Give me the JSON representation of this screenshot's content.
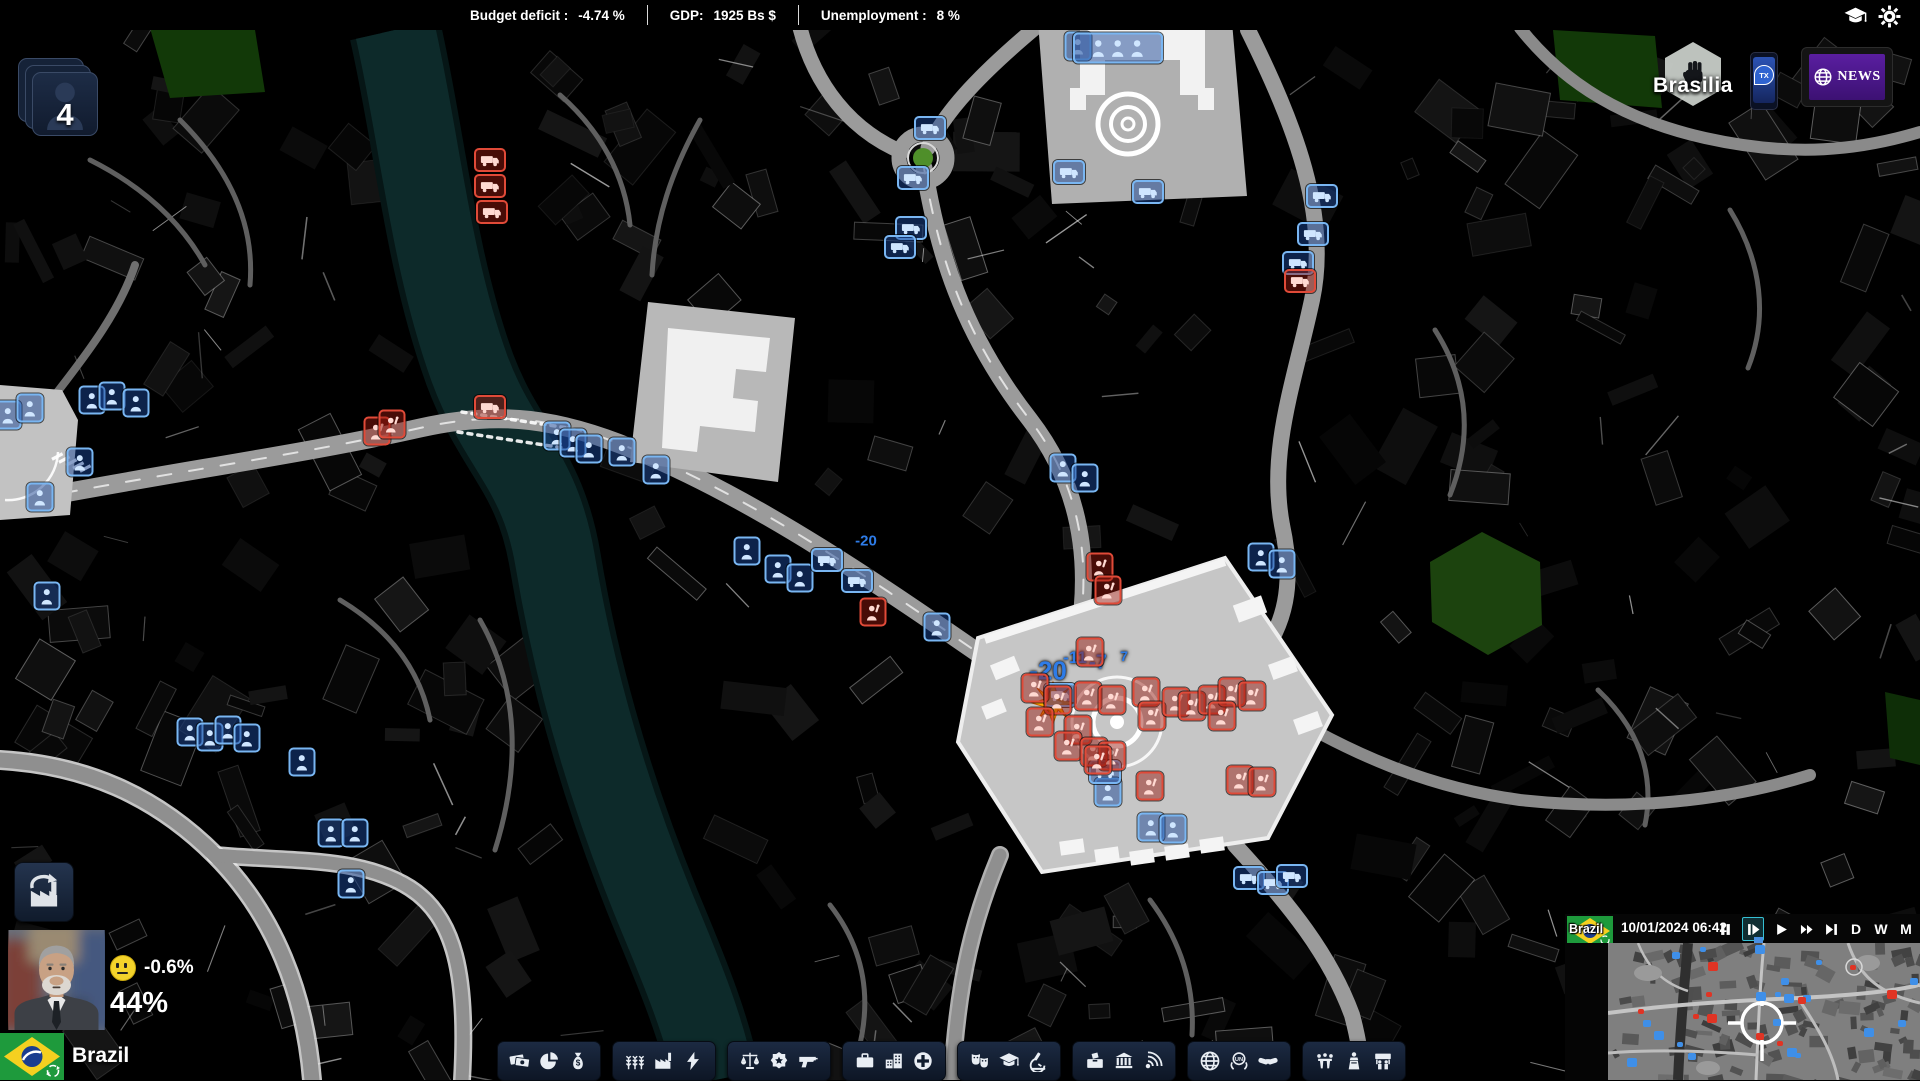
{
  "top_bar": {
    "budget_label": "Budget deficit :",
    "budget_value": "-4.74 %",
    "gdp_label": "GDP:",
    "gdp_value": "1925 Bs  $",
    "unemployment_label": "Unemployment :",
    "unemployment_value": "8 %"
  },
  "top_right_icons": [
    "education-icon",
    "settings-icon"
  ],
  "city": {
    "name": "Brasilia"
  },
  "phone": {
    "label": "TX"
  },
  "news": {
    "label": "NEWS"
  },
  "advisors": {
    "count": "4"
  },
  "player": {
    "mood_change": "-0.6%",
    "approval": "44%",
    "country": "Brazil"
  },
  "clock": {
    "date": "10/01/2024",
    "time": "06:42",
    "controls": [
      {
        "name": "pause"
      },
      {
        "name": "step",
        "active": true
      },
      {
        "name": "play"
      },
      {
        "name": "fast-forward"
      },
      {
        "name": "skip-forward"
      },
      {
        "name": "day",
        "label": "D"
      },
      {
        "name": "week",
        "label": "W"
      },
      {
        "name": "month",
        "label": "M"
      }
    ]
  },
  "toolbar": {
    "groups": [
      {
        "name": "economy",
        "icons": [
          "banknotes-icon",
          "budget-pie-icon",
          "tax-bag-icon"
        ]
      },
      {
        "name": "production",
        "icons": [
          "agriculture-icon",
          "industry-icon",
          "energy-icon"
        ]
      },
      {
        "name": "security",
        "icons": [
          "justice-icon",
          "police-icon",
          "defense-icon"
        ]
      },
      {
        "name": "society",
        "icons": [
          "labor-icon",
          "housing-icon",
          "health-icon"
        ]
      },
      {
        "name": "culture",
        "icons": [
          "culture-icon",
          "education-icon",
          "research-icon"
        ]
      },
      {
        "name": "state",
        "icons": [
          "elections-icon",
          "institutions-icon",
          "media-icon"
        ]
      },
      {
        "name": "foreign",
        "icons": [
          "world-icon",
          "un-icon",
          "diplomacy-icon"
        ]
      },
      {
        "name": "politics",
        "icons": [
          "meetings-icon",
          "government-icon",
          "social-movements-icon"
        ]
      }
    ]
  },
  "map": {
    "float_texts": [
      {
        "text": "-20",
        "x": 1048,
        "y": 671,
        "size": 26
      },
      {
        "text": "-11",
        "x": 1075,
        "y": 658,
        "size": 17
      },
      {
        "text": "-7",
        "x": 1098,
        "y": 663,
        "size": 20
      },
      {
        "text": "7",
        "x": 1124,
        "y": 656,
        "size": 14
      },
      {
        "text": "-20",
        "x": 866,
        "y": 541,
        "size": 15
      }
    ],
    "explosion": {
      "x": 1053,
      "y": 703
    },
    "markers": [
      {
        "t": "police-person",
        "x": 8,
        "y": 415
      },
      {
        "t": "police-person",
        "x": 30,
        "y": 408
      },
      {
        "t": "police-person",
        "x": 80,
        "y": 462
      },
      {
        "t": "police-person",
        "x": 40,
        "y": 497
      },
      {
        "t": "police-person",
        "x": 92,
        "y": 400
      },
      {
        "t": "police-person",
        "x": 112,
        "y": 396
      },
      {
        "t": "police-person",
        "x": 136,
        "y": 403
      },
      {
        "t": "police-person",
        "x": 47,
        "y": 596
      },
      {
        "t": "police-person",
        "x": 190,
        "y": 732
      },
      {
        "t": "police-person",
        "x": 210,
        "y": 737
      },
      {
        "t": "police-person",
        "x": 228,
        "y": 730
      },
      {
        "t": "police-person",
        "x": 247,
        "y": 738
      },
      {
        "t": "police-person",
        "x": 302,
        "y": 762
      },
      {
        "t": "police-person",
        "x": 331,
        "y": 833
      },
      {
        "t": "police-person",
        "x": 355,
        "y": 833
      },
      {
        "t": "police-person",
        "x": 351,
        "y": 884
      },
      {
        "t": "police-person",
        "x": 557,
        "y": 436
      },
      {
        "t": "police-person",
        "x": 573,
        "y": 443
      },
      {
        "t": "police-person",
        "x": 589,
        "y": 449
      },
      {
        "t": "police-person",
        "x": 622,
        "y": 452
      },
      {
        "t": "police-person",
        "x": 656,
        "y": 470
      },
      {
        "t": "police-person",
        "x": 747,
        "y": 551
      },
      {
        "t": "police-person",
        "x": 778,
        "y": 569
      },
      {
        "t": "police-person",
        "x": 800,
        "y": 578
      },
      {
        "t": "police-person",
        "x": 937,
        "y": 627
      },
      {
        "t": "police-person",
        "x": 1063,
        "y": 468
      },
      {
        "t": "police-person",
        "x": 1085,
        "y": 478
      },
      {
        "t": "police-person",
        "x": 1261,
        "y": 557
      },
      {
        "t": "police-person",
        "x": 1282,
        "y": 564
      },
      {
        "t": "police-person",
        "x": 1151,
        "y": 827
      },
      {
        "t": "police-person",
        "x": 1173,
        "y": 829
      },
      {
        "t": "police-person",
        "x": 1108,
        "y": 792
      },
      {
        "t": "police-person",
        "x": 1078,
        "y": 46
      },
      {
        "t": "police-vehicle",
        "x": 930,
        "y": 128
      },
      {
        "t": "police-vehicle",
        "x": 913,
        "y": 178
      },
      {
        "t": "police-vehicle",
        "x": 911,
        "y": 228
      },
      {
        "t": "police-vehicle",
        "x": 900,
        "y": 247
      },
      {
        "t": "police-vehicle",
        "x": 1069,
        "y": 172
      },
      {
        "t": "police-vehicle",
        "x": 1148,
        "y": 192
      },
      {
        "t": "police-vehicle",
        "x": 1322,
        "y": 196
      },
      {
        "t": "police-vehicle",
        "x": 1313,
        "y": 234
      },
      {
        "t": "police-vehicle",
        "x": 1298,
        "y": 263
      },
      {
        "t": "police-vehicle",
        "x": 827,
        "y": 560
      },
      {
        "t": "police-vehicle",
        "x": 857,
        "y": 581
      },
      {
        "t": "police-vehicle",
        "x": 1249,
        "y": 878
      },
      {
        "t": "police-vehicle",
        "x": 1273,
        "y": 883
      },
      {
        "t": "police-vehicle",
        "x": 1292,
        "y": 876
      },
      {
        "t": "police-vehicle",
        "x": 1060,
        "y": 695
      },
      {
        "t": "police-vehicle",
        "x": 1105,
        "y": 772
      },
      {
        "t": "police-group",
        "x": 1118,
        "y": 48
      },
      {
        "t": "riot-vehicle",
        "x": 490,
        "y": 160
      },
      {
        "t": "riot-vehicle",
        "x": 490,
        "y": 186
      },
      {
        "t": "riot-vehicle",
        "x": 492,
        "y": 212
      },
      {
        "t": "riot-vehicle",
        "x": 490,
        "y": 407
      },
      {
        "t": "riot-vehicle",
        "x": 1300,
        "y": 281
      },
      {
        "t": "rioter",
        "x": 377,
        "y": 431
      },
      {
        "t": "rioter",
        "x": 392,
        "y": 424
      },
      {
        "t": "rioter",
        "x": 873,
        "y": 612
      },
      {
        "t": "rioter",
        "x": 1090,
        "y": 652
      },
      {
        "t": "rioter",
        "x": 1035,
        "y": 688
      },
      {
        "t": "rioter",
        "x": 1058,
        "y": 700
      },
      {
        "t": "rioter",
        "x": 1088,
        "y": 696
      },
      {
        "t": "rioter",
        "x": 1112,
        "y": 700
      },
      {
        "t": "rioter",
        "x": 1040,
        "y": 722
      },
      {
        "t": "rioter",
        "x": 1078,
        "y": 730
      },
      {
        "t": "rioter",
        "x": 1068,
        "y": 746
      },
      {
        "t": "rioter",
        "x": 1094,
        "y": 752
      },
      {
        "t": "rioter",
        "x": 1112,
        "y": 756
      },
      {
        "t": "rioter",
        "x": 1146,
        "y": 692
      },
      {
        "t": "rioter",
        "x": 1152,
        "y": 716
      },
      {
        "t": "rioter",
        "x": 1176,
        "y": 702
      },
      {
        "t": "rioter",
        "x": 1192,
        "y": 706
      },
      {
        "t": "rioter",
        "x": 1212,
        "y": 700
      },
      {
        "t": "rioter",
        "x": 1232,
        "y": 692
      },
      {
        "t": "rioter",
        "x": 1252,
        "y": 696
      },
      {
        "t": "rioter",
        "x": 1222,
        "y": 716
      },
      {
        "t": "rioter",
        "x": 1240,
        "y": 780
      },
      {
        "t": "rioter",
        "x": 1262,
        "y": 782
      },
      {
        "t": "rioter",
        "x": 1150,
        "y": 786
      },
      {
        "t": "rioter",
        "x": 1098,
        "y": 760
      },
      {
        "t": "rioter",
        "x": 1100,
        "y": 567
      },
      {
        "t": "rioter",
        "x": 1108,
        "y": 590
      }
    ]
  },
  "minimap": {
    "country": "Brazil",
    "dots": [
      {
        "c": "blue",
        "x": 64,
        "y": 9
      },
      {
        "c": "blue",
        "x": 147,
        "y": 2
      },
      {
        "c": "blue",
        "x": 173,
        "y": 35
      },
      {
        "c": "blue",
        "x": 167,
        "y": 49
      },
      {
        "c": "blue",
        "x": 176,
        "y": 51
      },
      {
        "c": "blue",
        "x": 195,
        "y": 52
      },
      {
        "c": "blue",
        "x": 148,
        "y": 49
      },
      {
        "c": "blue",
        "x": 165,
        "y": 76
      },
      {
        "c": "blue",
        "x": 179,
        "y": 105
      },
      {
        "c": "blue",
        "x": 187,
        "y": 110
      },
      {
        "c": "blue",
        "x": 35,
        "y": 77
      },
      {
        "c": "blue",
        "x": 46,
        "y": 88
      },
      {
        "c": "blue",
        "x": 69,
        "y": 99
      },
      {
        "c": "blue",
        "x": 80,
        "y": 110
      },
      {
        "c": "blue",
        "x": 19,
        "y": 115
      },
      {
        "c": "blue",
        "x": 256,
        "y": 85
      },
      {
        "c": "blue",
        "x": 208,
        "y": 17
      },
      {
        "c": "blue",
        "x": 92,
        "y": 4
      },
      {
        "c": "blue",
        "x": 302,
        "y": 35
      },
      {
        "c": "blue",
        "x": 290,
        "y": 77
      },
      {
        "c": "red",
        "x": 98,
        "y": 49
      },
      {
        "c": "red",
        "x": 85,
        "y": 71
      },
      {
        "c": "red",
        "x": 99,
        "y": 71
      },
      {
        "c": "red",
        "x": 30,
        "y": 66
      },
      {
        "c": "red",
        "x": 148,
        "y": 90
      },
      {
        "c": "red",
        "x": 169,
        "y": 98
      },
      {
        "c": "red",
        "x": 190,
        "y": 54
      },
      {
        "c": "red",
        "x": 279,
        "y": 47
      },
      {
        "c": "red",
        "x": 100,
        "y": 19
      },
      {
        "c": "red",
        "x": 242,
        "y": 22
      }
    ]
  }
}
